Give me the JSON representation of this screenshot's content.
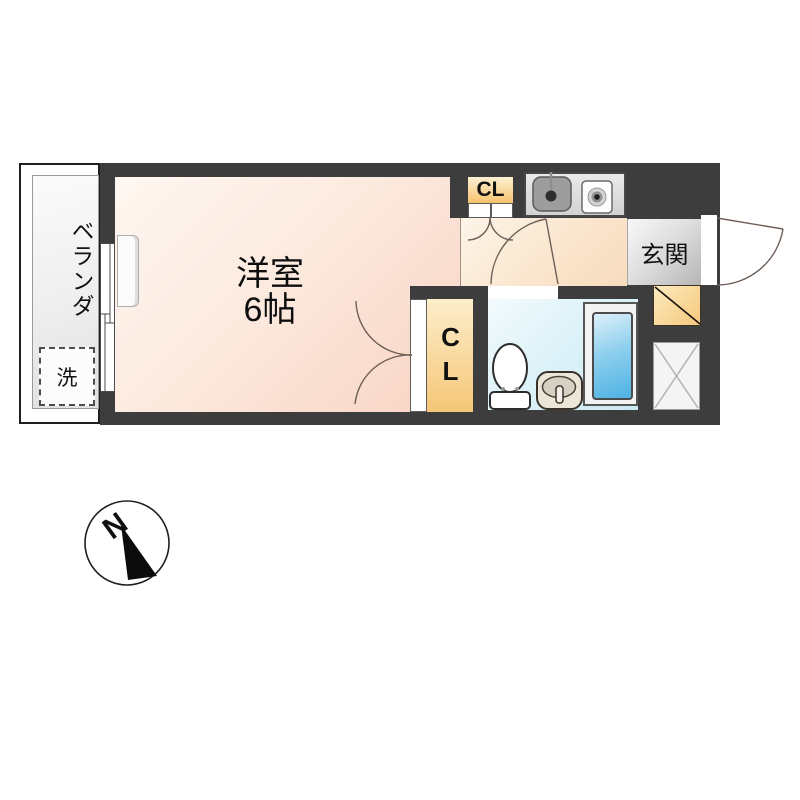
{
  "plan": {
    "balcony": {
      "label": "ベランダ",
      "washer": "洗"
    },
    "room": {
      "name": "洋室",
      "size": "6帖"
    },
    "closet_top": {
      "label": "CL"
    },
    "closet_main": {
      "label": "CL"
    },
    "entrance": {
      "label": "玄関"
    },
    "compass": {
      "north": "N"
    },
    "colors": {
      "wall": "#3d3d3d",
      "room_pink": "#f8d3c2",
      "corridor_peach": "#f7dbbe",
      "closet_orange": "#f5c678",
      "bathroom_blue": "#c9eaf3",
      "bathtub_blue": "#4eb2e4",
      "genkan_gray": "#b5b5b5",
      "shoe_box_orange": "#f5c87e"
    }
  }
}
